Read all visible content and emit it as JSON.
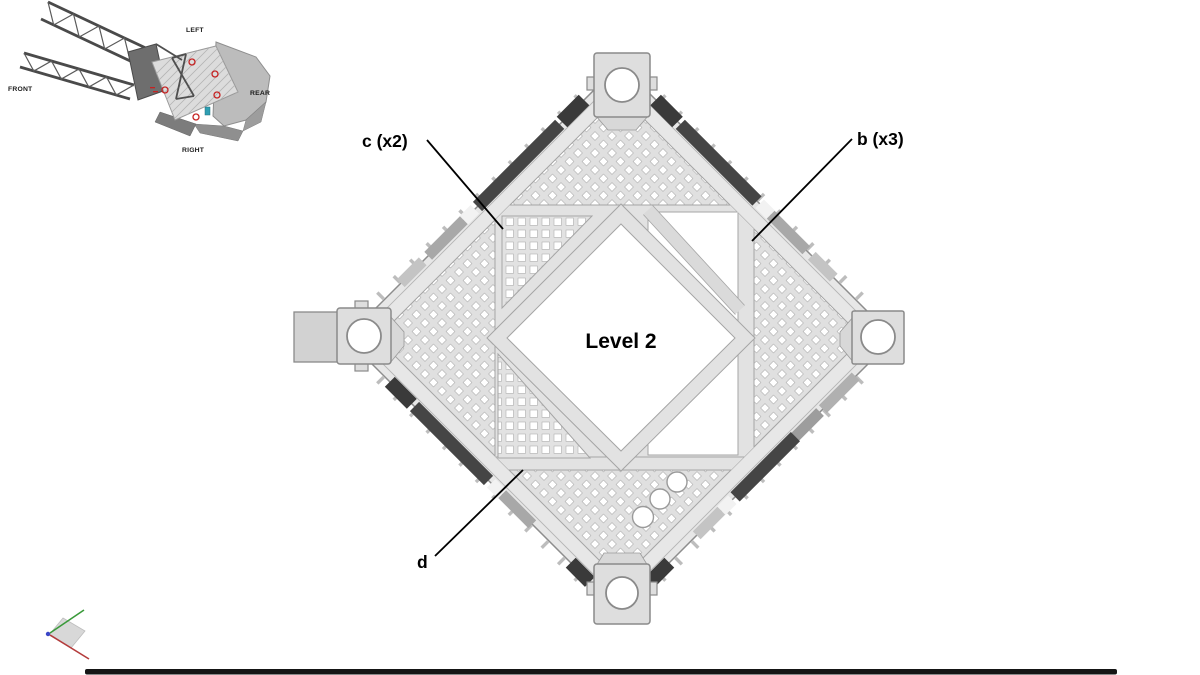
{
  "slide": {
    "main_label": "Level 2",
    "callouts": {
      "c": "c (x2)",
      "b": "b (x3)",
      "d": "d"
    },
    "inset": {
      "front": "FRONT",
      "left": "LEFT",
      "rear": "REAR",
      "right": "RIGHT"
    },
    "colors": {
      "deck_fill": "#e7e7e7",
      "holes_fill": "#e0e0e0",
      "panel_fill": "#e2e2e2",
      "beam_stroke": "#a2a2a2",
      "deck_stroke": "#8d8d8d",
      "rail_dark": "#454545",
      "rail_light": "#a8a8a8",
      "opening_white": "#ffffff",
      "footer_bar": "#151515",
      "axis_x_red": "#b43c3c",
      "axis_y_green": "#3a9a3a",
      "axis_z_blue": "#3a46c8",
      "marker_red": "#c52222",
      "marker_teal": "#2f9fb3"
    }
  }
}
